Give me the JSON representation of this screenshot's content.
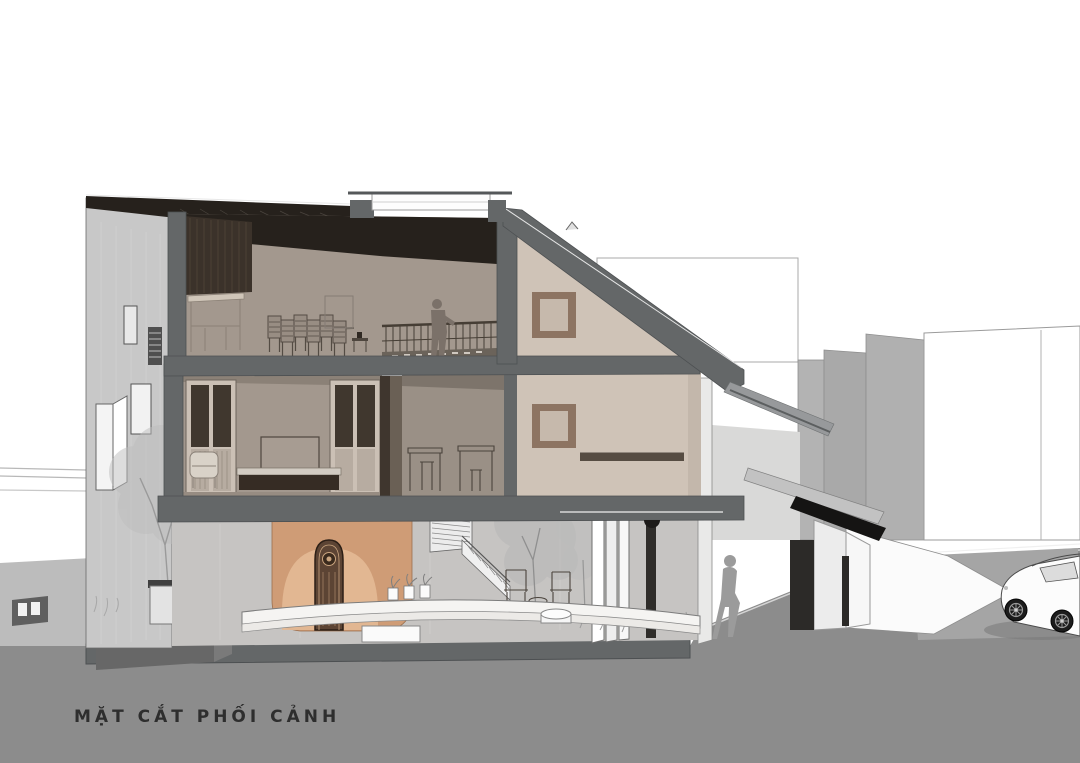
{
  "title": "MẶT CẮT PHỐI CẢNH",
  "drawing": {
    "kind": "sectional perspective rendering of a multi-storey house",
    "figures": [
      "walking person in front yard",
      "walking person in rear courtyard",
      "standing person at balcony railing"
    ],
    "vehicle": "car parked on street at right"
  },
  "colors": {
    "paper": "#ffffff",
    "ground": "#8c8c8c",
    "cut": "#646768",
    "roof_dark": "#26211c",
    "wall_light": "#c8c8c8",
    "interior_taupe": "#a3988e",
    "interior_taupe_dark": "#9a9086",
    "gable_beige": "#cfc3b7",
    "window_frame_brown": "#8d7462",
    "terracotta": "#cf9c76",
    "terracotta_light": "#e3b893",
    "door_brown": "#5c4434",
    "silhouette": "#8a8a8a",
    "bench_white": "#f5f4f2",
    "title_color": "#2e2e2e"
  }
}
